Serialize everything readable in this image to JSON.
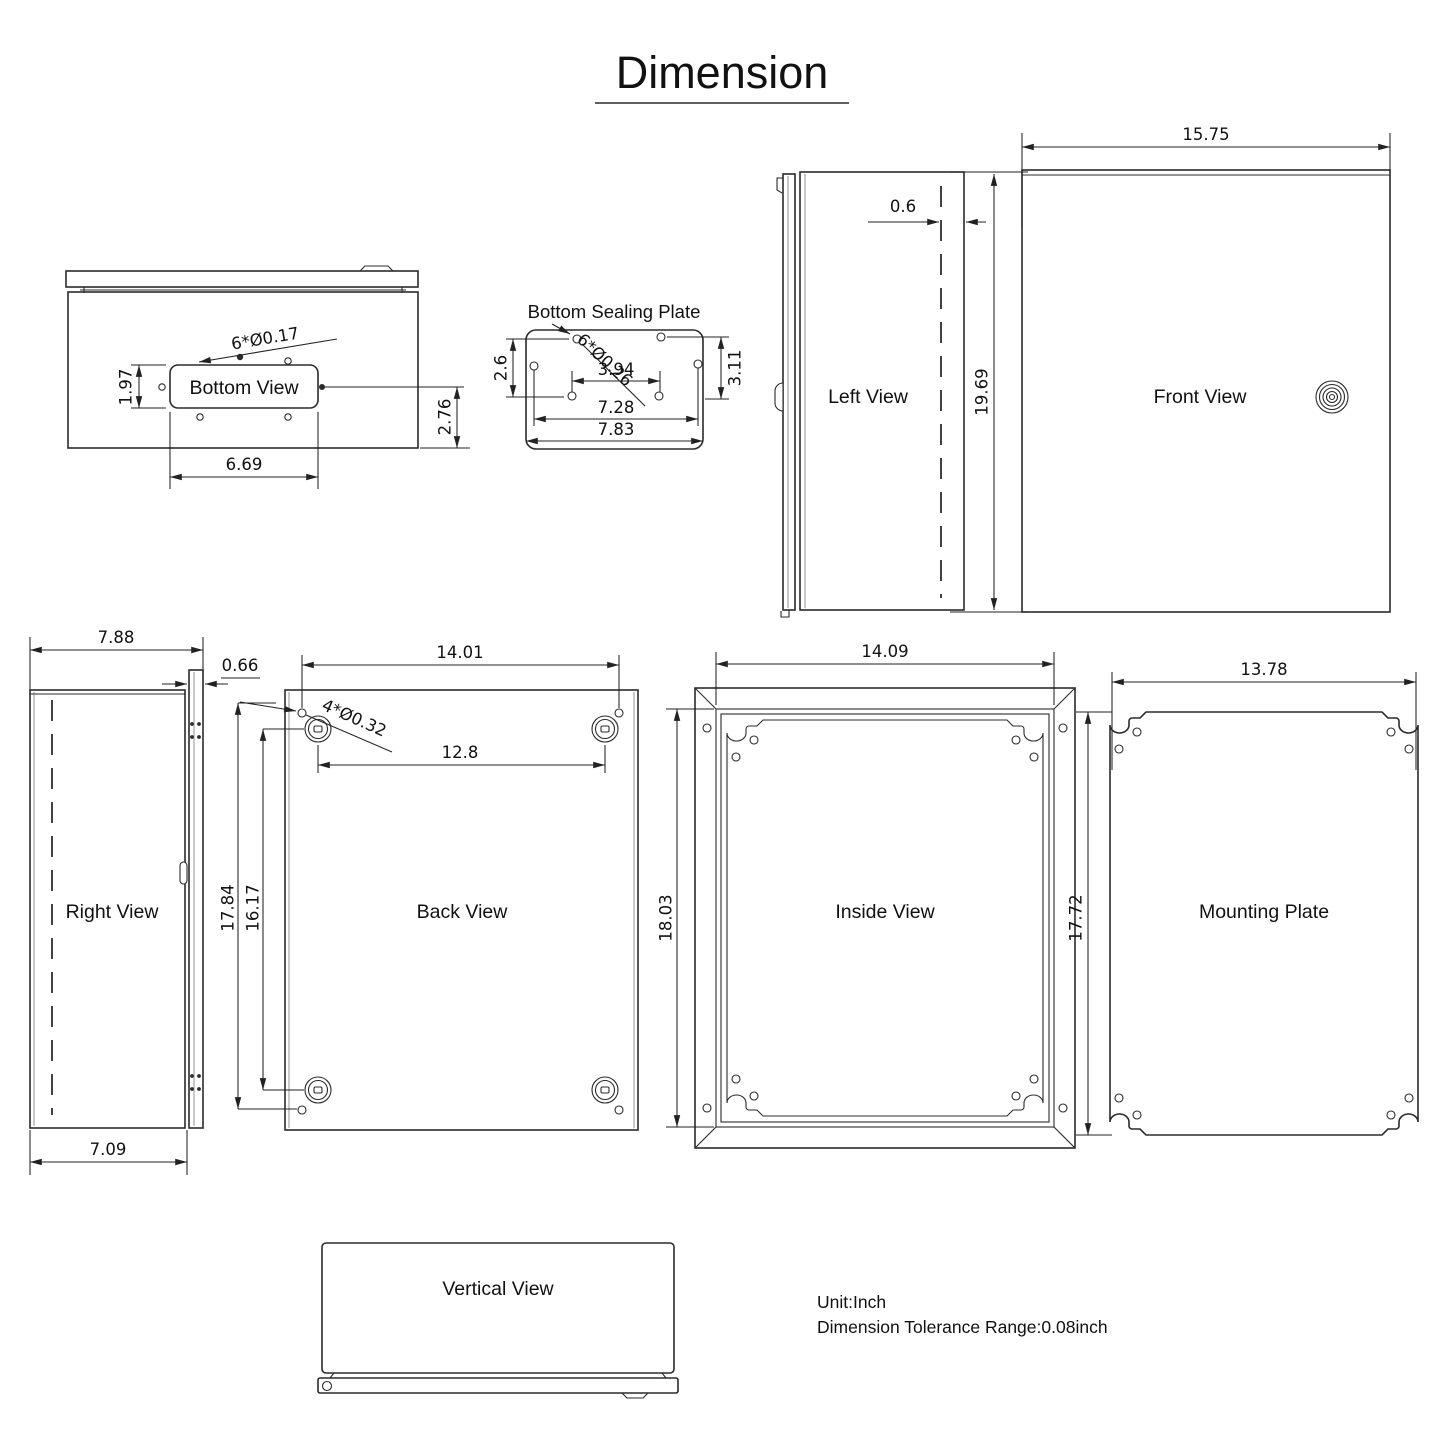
{
  "title": "Dimension",
  "footer": {
    "unit": "Unit:Inch",
    "tolerance": "Dimension Tolerance Range:0.08inch"
  },
  "views": {
    "bottom": {
      "label": "Bottom View",
      "holes": "6*Ø0.17",
      "h": "1.97",
      "offset": "2.76",
      "w": "6.69"
    },
    "sealing": {
      "label": "Bottom Sealing Plate",
      "holes": "6*Ø0.26",
      "left_h": "2.6",
      "right_h": "3.11",
      "inner_w": "3.94",
      "mid_w": "7.28",
      "outer_w": "7.83"
    },
    "left": {
      "label": "Left View",
      "door": "0.6"
    },
    "front": {
      "label": "Front View",
      "w": "15.75",
      "h": "19.69"
    },
    "right": {
      "label": "Right View",
      "top_w": "7.88",
      "door": "0.66",
      "bottom_w": "7.09"
    },
    "back": {
      "label": "Back View",
      "top_w": "14.01",
      "holes": "4*Ø0.32",
      "bolt_w": "12.8",
      "h_outer": "17.84",
      "h_inner": "16.17"
    },
    "inside": {
      "label": "Inside View",
      "w": "14.09",
      "h": "18.03"
    },
    "mounting": {
      "label": "Mounting Plate",
      "w": "13.78",
      "h": "17.72"
    },
    "vertical": {
      "label": "Vertical View"
    }
  }
}
